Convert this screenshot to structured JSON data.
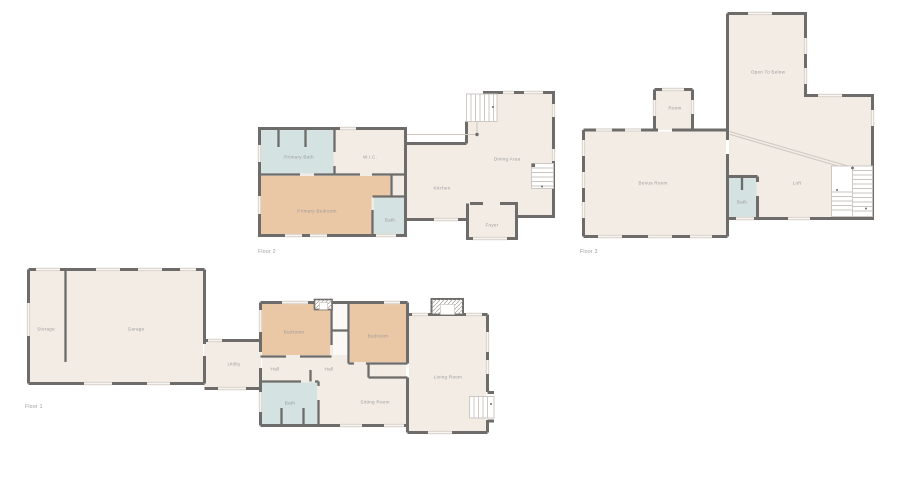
{
  "palette": {
    "background": "#ffffff",
    "floor": "#f3ece5",
    "bedroom": "#eac7a5",
    "bath": "#d4e2e1",
    "closet": "#fbf8f5",
    "wall": "#6d6c6a",
    "window": "#ded8d1",
    "window_line": "#f7f5f2",
    "stairs": "#ffffff",
    "stair_line": "#c9c4bf",
    "railing": "#cfc9c3",
    "post": "#6d6c6a",
    "label": "#9b9b9b"
  },
  "floors": [
    {
      "id": "floor-1",
      "label": "Floor 1",
      "rooms": [
        {
          "name": "Storage"
        },
        {
          "name": "Garage"
        },
        {
          "name": "Utility"
        },
        {
          "name": "Hall"
        },
        {
          "name": "Hall"
        },
        {
          "name": "Bedroom"
        },
        {
          "name": "Bedroom"
        },
        {
          "name": "Bath"
        },
        {
          "name": "Sitting Room"
        },
        {
          "name": "Living Room"
        }
      ]
    },
    {
      "id": "floor-2",
      "label": "Floor 2",
      "rooms": [
        {
          "name": "Primary Bath"
        },
        {
          "name": "W.I.C."
        },
        {
          "name": "Primary Bedroom"
        },
        {
          "name": "Bath"
        },
        {
          "name": "Kitchen"
        },
        {
          "name": "Dining Area"
        },
        {
          "name": "Foyer"
        }
      ]
    },
    {
      "id": "floor-3",
      "label": "Floor 3",
      "rooms": [
        {
          "name": "Open To Below"
        },
        {
          "name": "Room"
        },
        {
          "name": "Bonus Room"
        },
        {
          "name": "Bath"
        },
        {
          "name": "Loft"
        }
      ]
    }
  ]
}
